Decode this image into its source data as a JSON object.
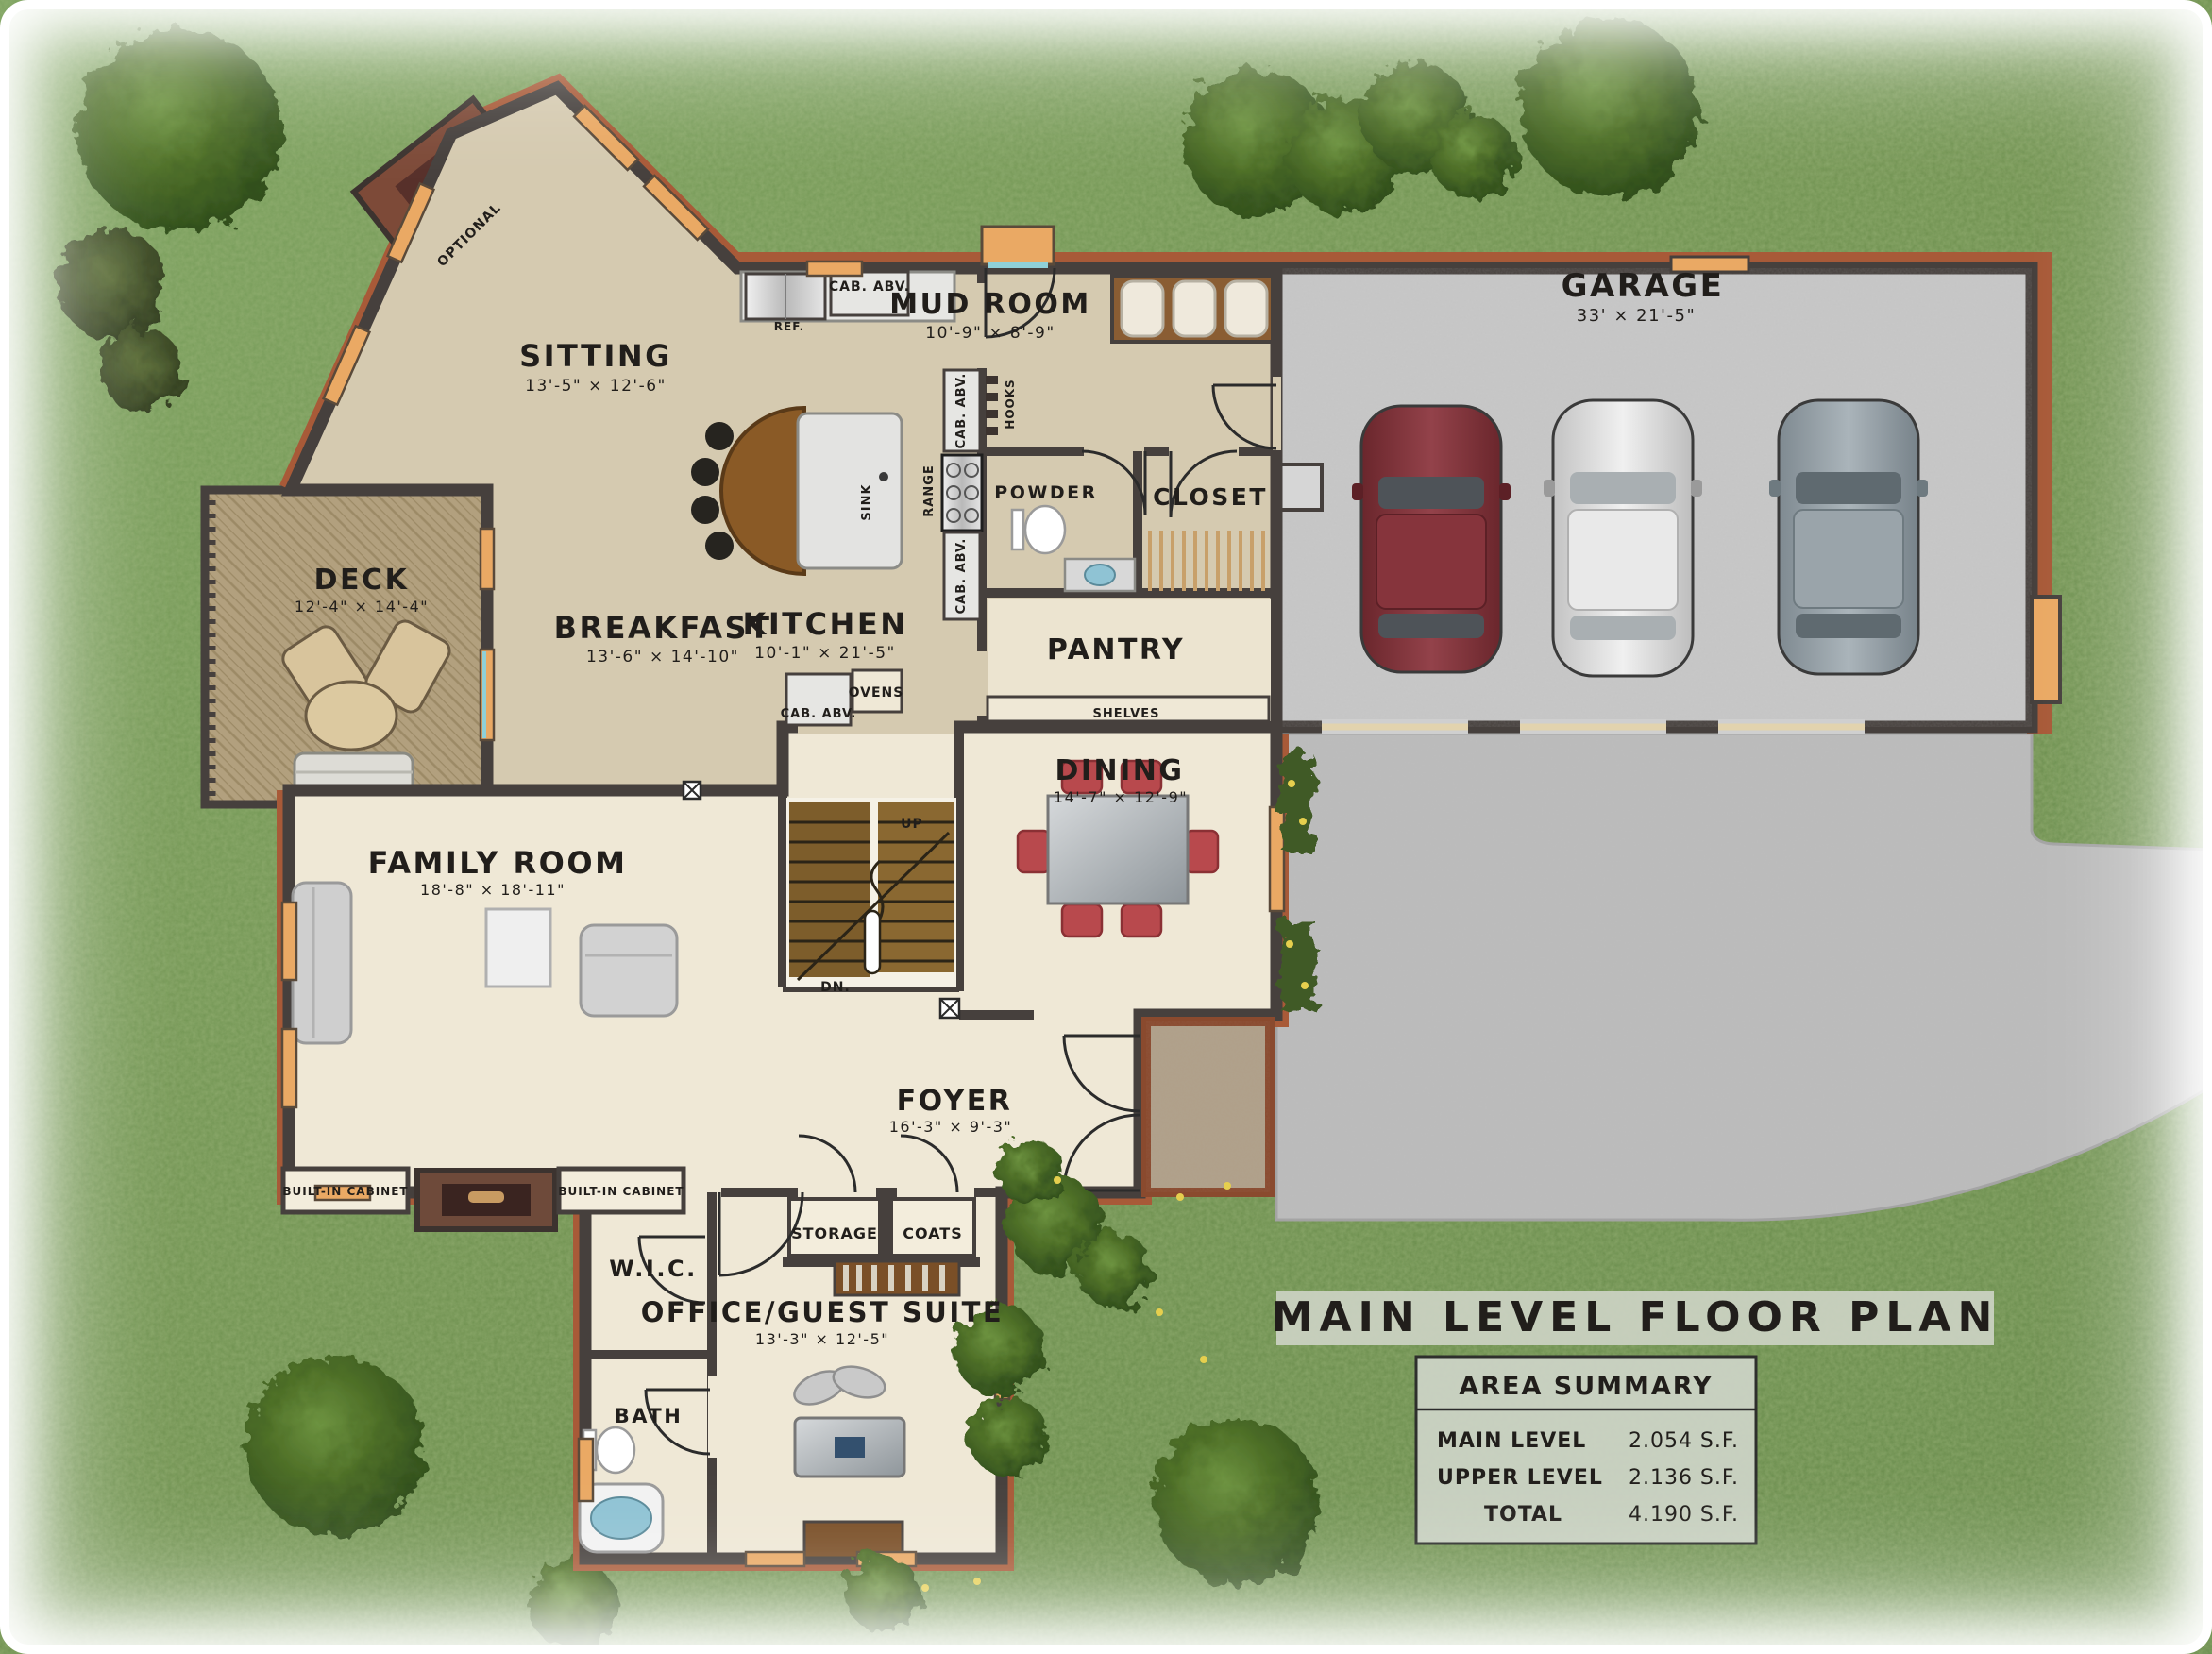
{
  "title": "MAIN LEVEL FLOOR PLAN",
  "area_summary": {
    "heading": "AREA SUMMARY",
    "rows": [
      {
        "label": "MAIN LEVEL",
        "value": "2.054 S.F."
      },
      {
        "label": "UPPER LEVEL",
        "value": "2.136 S.F."
      },
      {
        "label": "TOTAL",
        "value": "4.190 S.F."
      }
    ]
  },
  "rooms": {
    "sitting": {
      "name": "SITTING",
      "dims": "13'-5\" × 12'-6\""
    },
    "mud_room": {
      "name": "MUD ROOM",
      "dims": "10'-9\" × 8'-9\""
    },
    "garage": {
      "name": "GARAGE",
      "dims": "33' × 21'-5\""
    },
    "deck": {
      "name": "DECK",
      "dims": "12'-4\" × 14'-4\""
    },
    "breakfast": {
      "name": "BREAKFAST",
      "dims": "13'-6\" × 14'-10\""
    },
    "kitchen": {
      "name": "KITCHEN",
      "dims": "10'-1\" × 21'-5\""
    },
    "pantry": {
      "name": "PANTRY"
    },
    "powder": {
      "name": "POWDER"
    },
    "closet": {
      "name": "CLOSET"
    },
    "dining": {
      "name": "DINING",
      "dims": "14'-7\" × 12'-9\""
    },
    "family_room": {
      "name": "FAMILY  ROOM",
      "dims": "18'-8\" × 18'-11\""
    },
    "foyer": {
      "name": "FOYER",
      "dims": "16'-3\" × 9'-3\""
    },
    "wic": {
      "name": "W.I.C."
    },
    "bath": {
      "name": "BATH"
    },
    "office": {
      "name": "OFFICE/GUEST SUITE",
      "dims": "13'-3\" × 12'-5\""
    },
    "storage": {
      "name": "STORAGE"
    },
    "coats": {
      "name": "COATS"
    }
  },
  "annotations": {
    "optional": "OPTIONAL",
    "cab_abv": "CAB. ABV.",
    "ref": "REF.",
    "range": "RANGE",
    "hooks": "HOOKS",
    "sink": "SINK",
    "ovens": "OVENS",
    "shelves": "SHELVES",
    "up": "UP",
    "dn": "DN.",
    "built_in_cabinet": "BUILT-IN CABINET"
  },
  "colors": {
    "grass": "#6f9150",
    "wall": "#46403d",
    "brick_trim": "#a85a38",
    "floor_tan": "#d5cab0",
    "floor_cream": "#efe8d6",
    "concrete": "#c2c2c2",
    "window_accent": "#eaa964",
    "title_band": "#cbd2c3",
    "stair_wood": "#7d5d2b",
    "dining_chair": "#b8494d",
    "car_maroon": "#7b3038",
    "car_silver": "#d9d9d9",
    "car_gray": "#97a1a8"
  }
}
